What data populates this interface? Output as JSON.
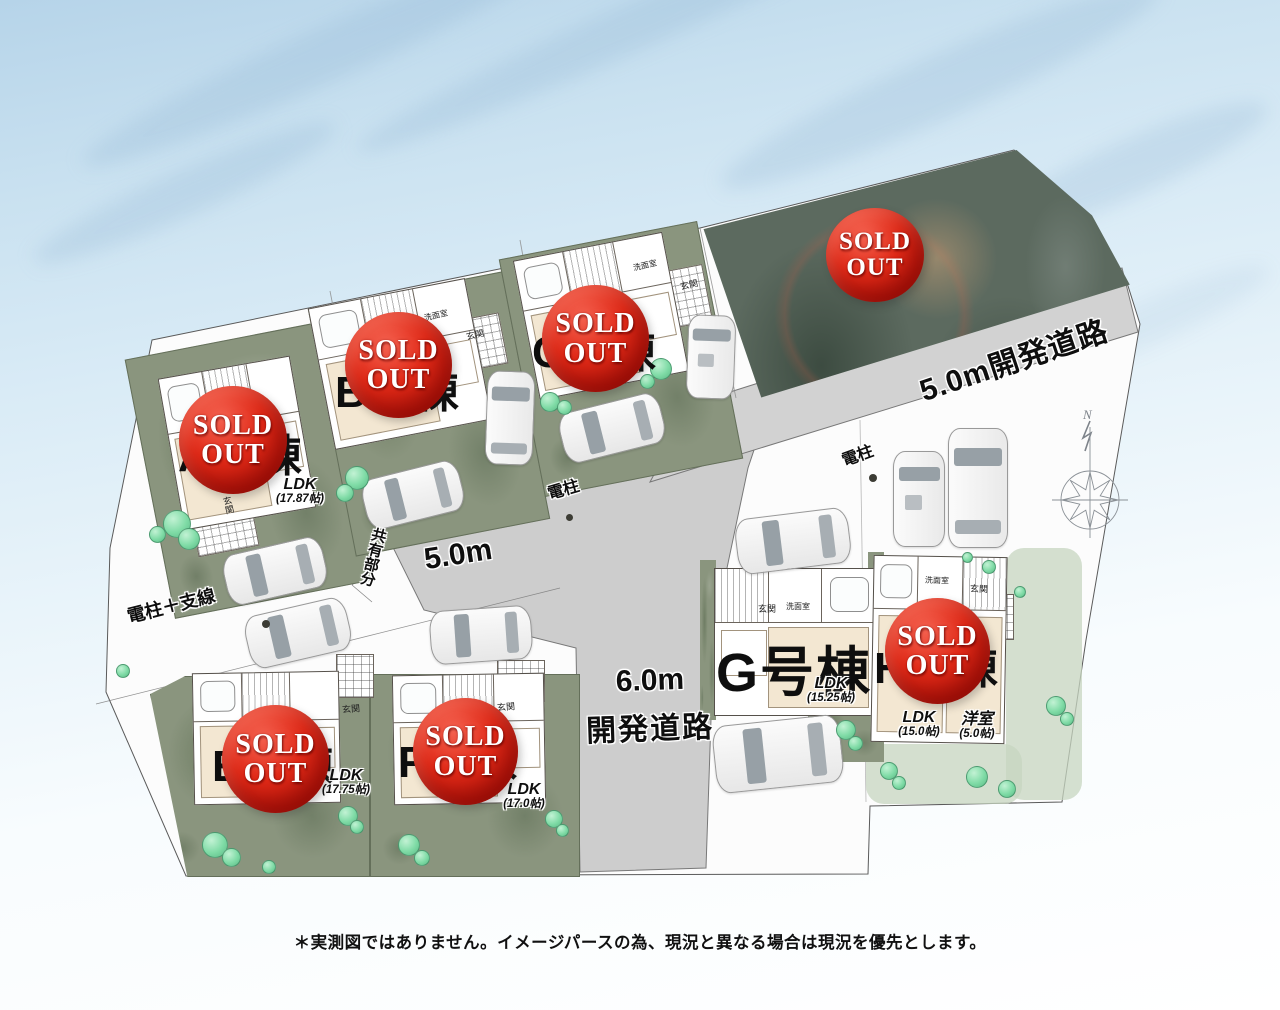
{
  "page": {
    "disclaimer": "＊実測図ではありません。イメージパースの為、現況と異なる場合は現況を優先とします。"
  },
  "sold_badge": {
    "line1": "SOLD",
    "line2": "OUT"
  },
  "roads": {
    "dev_road_5m_label": "5.0m開発道路",
    "road_width_label": "5.0m",
    "dev_road_6m_width": "6.0m",
    "dev_road_6m_label": "開発道路",
    "shared_area_label": "共有部分"
  },
  "utilities": {
    "pole_center_label": "電柱",
    "pole_right_label": "電柱",
    "pole_with_wire_label": "電柱＋支線"
  },
  "compass": {
    "north_label": "N"
  },
  "lots": [
    {
      "id": "A",
      "label": "A号棟",
      "ldk_label": "LDK",
      "ldk_size": "(17.87帖)",
      "entrance_label": "玄関",
      "status": "sold_out"
    },
    {
      "id": "B",
      "label": "B号棟",
      "washroom_label": "洗面室",
      "entrance_label": "玄関",
      "status": "sold_out"
    },
    {
      "id": "C",
      "label": "C号棟",
      "washroom_label": "洗面室",
      "entrance_label": "玄関",
      "status": "sold_out"
    },
    {
      "id": "D",
      "label": "",
      "status": "sold_out"
    },
    {
      "id": "E",
      "label": "E号棟",
      "ldk_label": "LDK",
      "ldk_size": "(17.75帖)",
      "entrance_label": "玄関",
      "status": "sold_out"
    },
    {
      "id": "F",
      "label": "F号棟",
      "ldk_label": "LDK",
      "ldk_size": "(17.0帖)",
      "entrance_label": "玄関",
      "status": "sold_out"
    },
    {
      "id": "G",
      "label": "G号棟",
      "ldk_label": "LDK",
      "ldk_size": "(15.25帖)",
      "washroom_label": "洗面室",
      "entrance_label": "玄関",
      "status": "for_sale"
    },
    {
      "id": "H",
      "label": "H号棟",
      "ldk_label": "LDK",
      "ldk_size": "(15.0帖)",
      "western_room_label": "洋室",
      "western_room_size": "(5.0帖)",
      "washroom_label": "洗面室",
      "entrance_label": "玄関",
      "status": "sold_out"
    }
  ]
}
